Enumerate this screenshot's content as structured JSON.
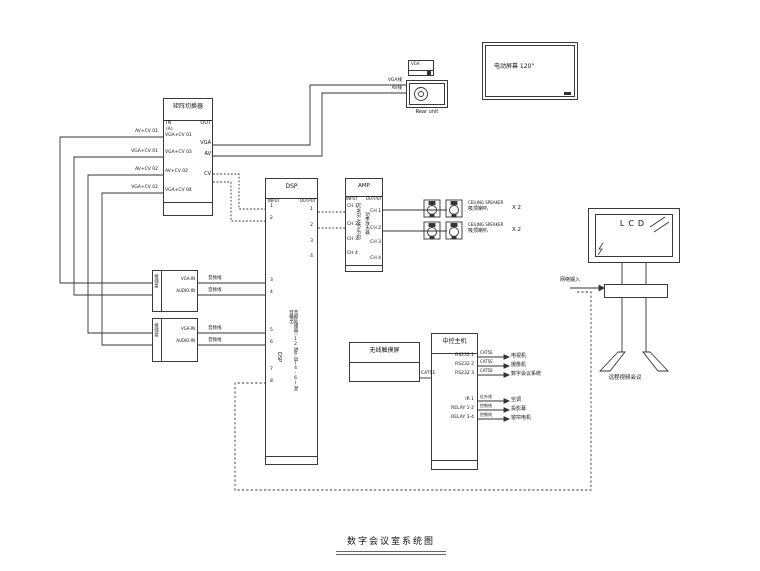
{
  "footer": {
    "title": "数字会议室系统图"
  },
  "matrix": {
    "title": "矩阵切换器",
    "in_label": "IN",
    "out_label": "OUT",
    "tag": "(A)",
    "in_ports": [
      "VGA+CV 01",
      "VGA+CV 03",
      "AV+CV 02",
      "VGA+CV 04"
    ],
    "out_ports": [
      "VGA",
      "AV",
      "CV"
    ],
    "wire_labels": [
      "AV+CV 01",
      "VGA+CV 01",
      "AV+CV 02",
      "VGA+CV 02"
    ]
  },
  "projector": {
    "label": "Rear unit",
    "vga_wire": "VGA线",
    "av_wire": "AV线",
    "plate_label": "VGA"
  },
  "screen": {
    "label": "电动屏幕 120\""
  },
  "dsp": {
    "title": "DSP",
    "in_label": "INPUT",
    "out_label": "OUTPUT",
    "inputs": [
      "1",
      "2",
      "3",
      "4",
      "5",
      "6",
      "7",
      "8"
    ],
    "outputs": [
      "1",
      "2",
      "3",
      "4"
    ],
    "vertical_label": "DSP",
    "vertical_desc": "音频处理器－12进8出(4-6)混音输出"
  },
  "amp": {
    "title": "AMP",
    "in_label": "INPUT",
    "out_label": "OUTPUT",
    "inputs": [
      "CH 1",
      "CH 2",
      "CH 3",
      "CH 4"
    ],
    "outputs": [
      "CH 1",
      "CH 2",
      "CH 3",
      "CH 4"
    ],
    "vertical_en": "POWER AMPLIFIER",
    "vertical_cn": "功率放大器"
  },
  "speakers": {
    "rows": [
      {
        "en": "CEILING SPEAKER",
        "cn": "吸顶喇叭",
        "qty": "X 2"
      },
      {
        "en": "CEILING SPEAKER",
        "cn": "吸顶喇叭",
        "qty": "X 2"
      }
    ]
  },
  "floor_boxes": [
    {
      "vertical": "接线盒",
      "rows": [
        "VGA-IN",
        "AUDIO-IN"
      ],
      "wires": [
        "音频线",
        "音频线"
      ]
    },
    {
      "vertical": "接线盒",
      "rows": [
        "VGA-IN",
        "AUDIO-IN"
      ],
      "wires": [
        "音频线",
        "音频线"
      ]
    }
  ],
  "touch_panel": {
    "label": "无线触摸屏",
    "cable": "CAT5E"
  },
  "controller": {
    "title": "中控主机",
    "rows": [
      {
        "port": "RS232 1",
        "cable": "CAT5E",
        "target": "电视机"
      },
      {
        "port": "RS232 2",
        "cable": "CAT5E",
        "target": "摄像机"
      },
      {
        "port": "RS232 3",
        "cable": "CAT5E",
        "target": "数字会议系统"
      },
      {
        "port": "IR 1",
        "cable": "红外线",
        "target": "空调"
      },
      {
        "port": "RELAY 1-2",
        "cable": "控制线",
        "target": "投影幕"
      },
      {
        "port": "RELAY 3-4",
        "cable": "控制线",
        "target": "窗帘电机"
      }
    ]
  },
  "vtc": {
    "screen_label": "LCD",
    "input_label": "网络输入",
    "caption": "远程视频会议"
  },
  "colors": {
    "line": "#333333",
    "text": "#111111"
  }
}
